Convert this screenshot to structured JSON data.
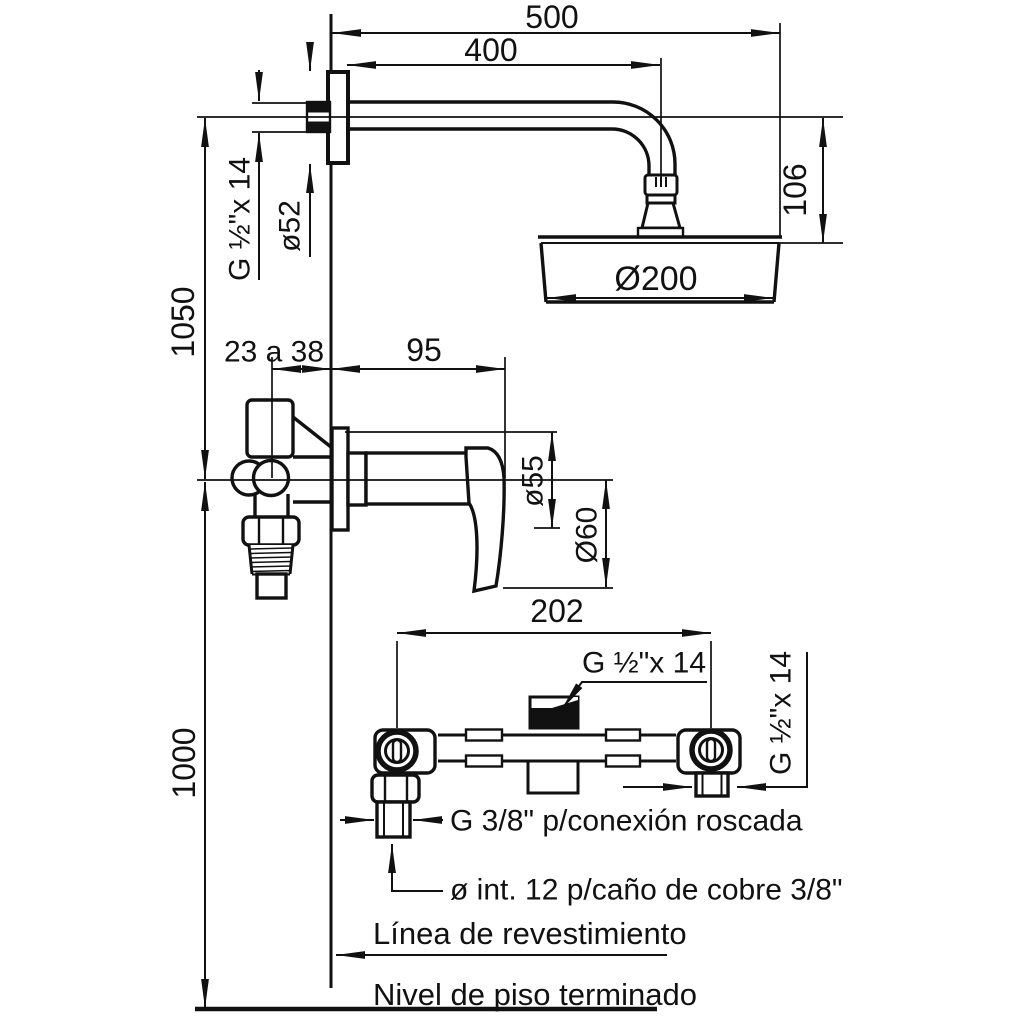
{
  "drawing": {
    "dimensions": {
      "overall_width": "500",
      "arm_reach": "400",
      "head_drop": "106",
      "head_diameter": "Ø200",
      "flange_diameter": "ø52",
      "thread_arm": "G ½\"x 14",
      "arm_height": "1050",
      "wall_depth_range": "23 a 38",
      "body_projection": "95",
      "escutcheon_diameter": "ø55",
      "handle_diameter": "Ø60",
      "inlet_centers": "202",
      "mixer_height": "1000",
      "thread_center": "G ½\"x 14",
      "thread_right": "G ½\"x 14"
    },
    "labels": {
      "bottom_connection": "G 3/8\" p/conexión roscada",
      "pipe_note": "ø int. 12 p/caño de cobre 3/8\"",
      "tile_line": "Línea de revestimiento",
      "floor_line": "Nivel de piso terminado"
    }
  }
}
